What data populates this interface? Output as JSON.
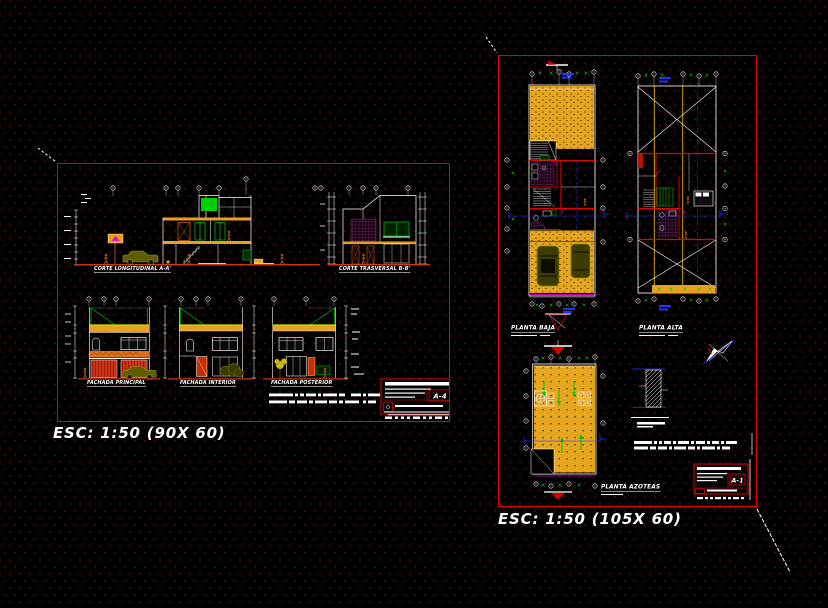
{
  "palette": {
    "background": "#000000",
    "grid_dot": "#4f0808",
    "sheet_border": "#e60000",
    "linework": "#ffffff",
    "hatch_yellow": "#e6a51f",
    "accent_green": "#00cc00",
    "accent_blue": "#2233ff",
    "accent_magenta": "#ff00ff",
    "tile_purple": "#b03fae",
    "cornice_orange": "#e07018",
    "door_red": "#c81800",
    "car_olive": "#7a7a00",
    "figure_brown": "#9c5020"
  },
  "left_sheet": {
    "scale_note": "ESC: 1:50 (90X 60)",
    "title_block": {
      "sheet_code": "A-4"
    },
    "drawings": {
      "corte_longitudinal": {
        "label": "CORTE LONGITUDINAL A-A'"
      },
      "corte_trasversal": {
        "label": "CORTE TRASVERSAL B-B'"
      },
      "fachada_principal": {
        "label": "FACHADA PRINCIPAL"
      },
      "fachada_interior": {
        "label": "FACHADA INTERIOR"
      },
      "fachada_posterior": {
        "label": "FACHADA POSTERIOR"
      }
    }
  },
  "right_sheet": {
    "scale_note": "ESC: 1:50 (105X 60)",
    "title_block": {
      "sheet_code": "A-1"
    },
    "drawings": {
      "planta_baja": {
        "label": "PLANTA BAJA"
      },
      "planta_alta": {
        "label": "PLANTA ALTA"
      },
      "planta_azoteas": {
        "label": "PLANTA AZOTEAS"
      }
    }
  }
}
